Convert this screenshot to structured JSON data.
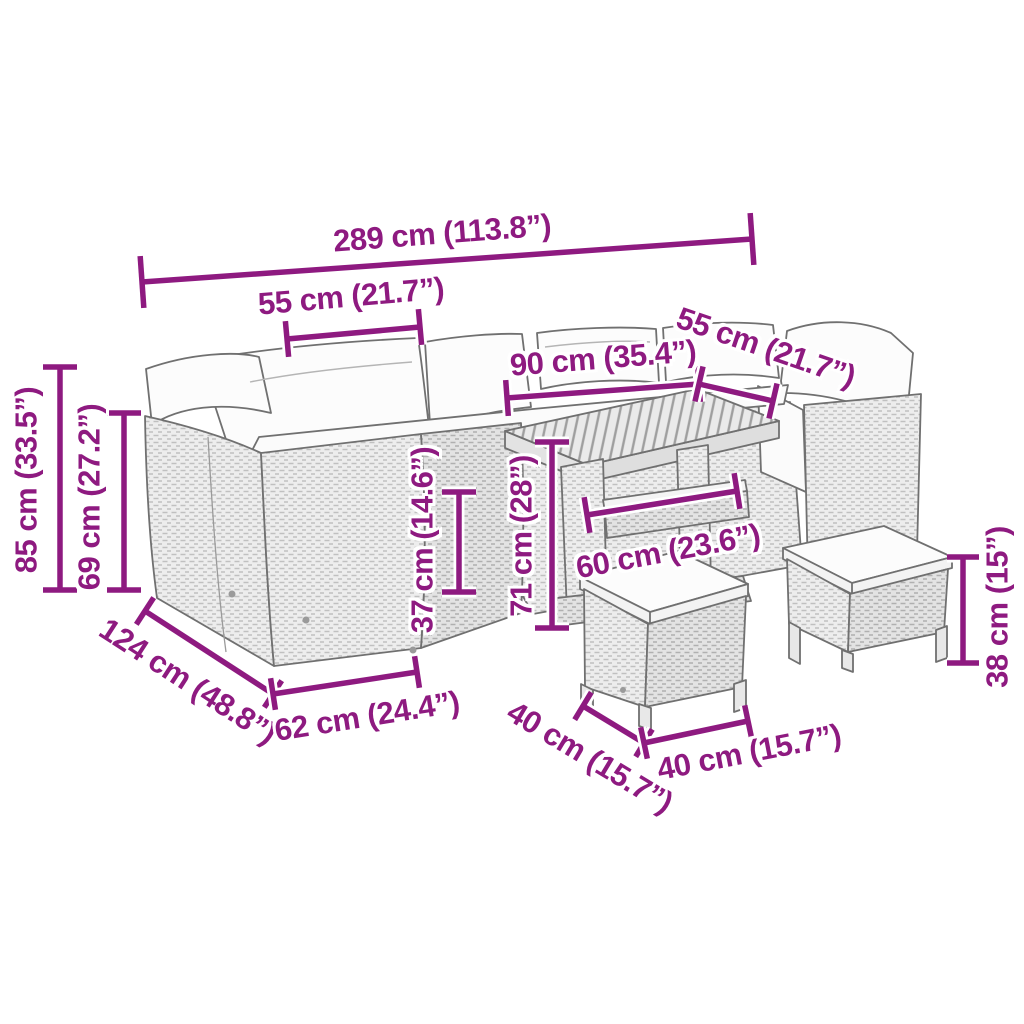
{
  "page": {
    "background_color": "#ffffff",
    "accent_color": "#8E1A80",
    "illustration": "rattan-garden-lounge-set-with-table-and-stools-line-drawing"
  },
  "dimensions": {
    "total_width": "289 cm (113.8”)",
    "seat_module_width_left": "55 cm (21.7”)",
    "seat_module_width_right": "55 cm (21.7”)",
    "table_length": "90 cm (35.4”)",
    "sofa_height": "85 cm (33.5”)",
    "backrest_height": "69 cm (27.2”)",
    "seat_height": "37 cm (14.6”)",
    "table_height": "71 cm (28”)",
    "table_depth": "60 cm (23.6”)",
    "sofa_depth": "124 cm (48.8”)",
    "module_depth": "62 cm (24.4”)",
    "stool_depth": "40 cm (15.7”)",
    "stool_width": "40 cm (15.7”)",
    "stool_height": "38 cm (15”)"
  }
}
